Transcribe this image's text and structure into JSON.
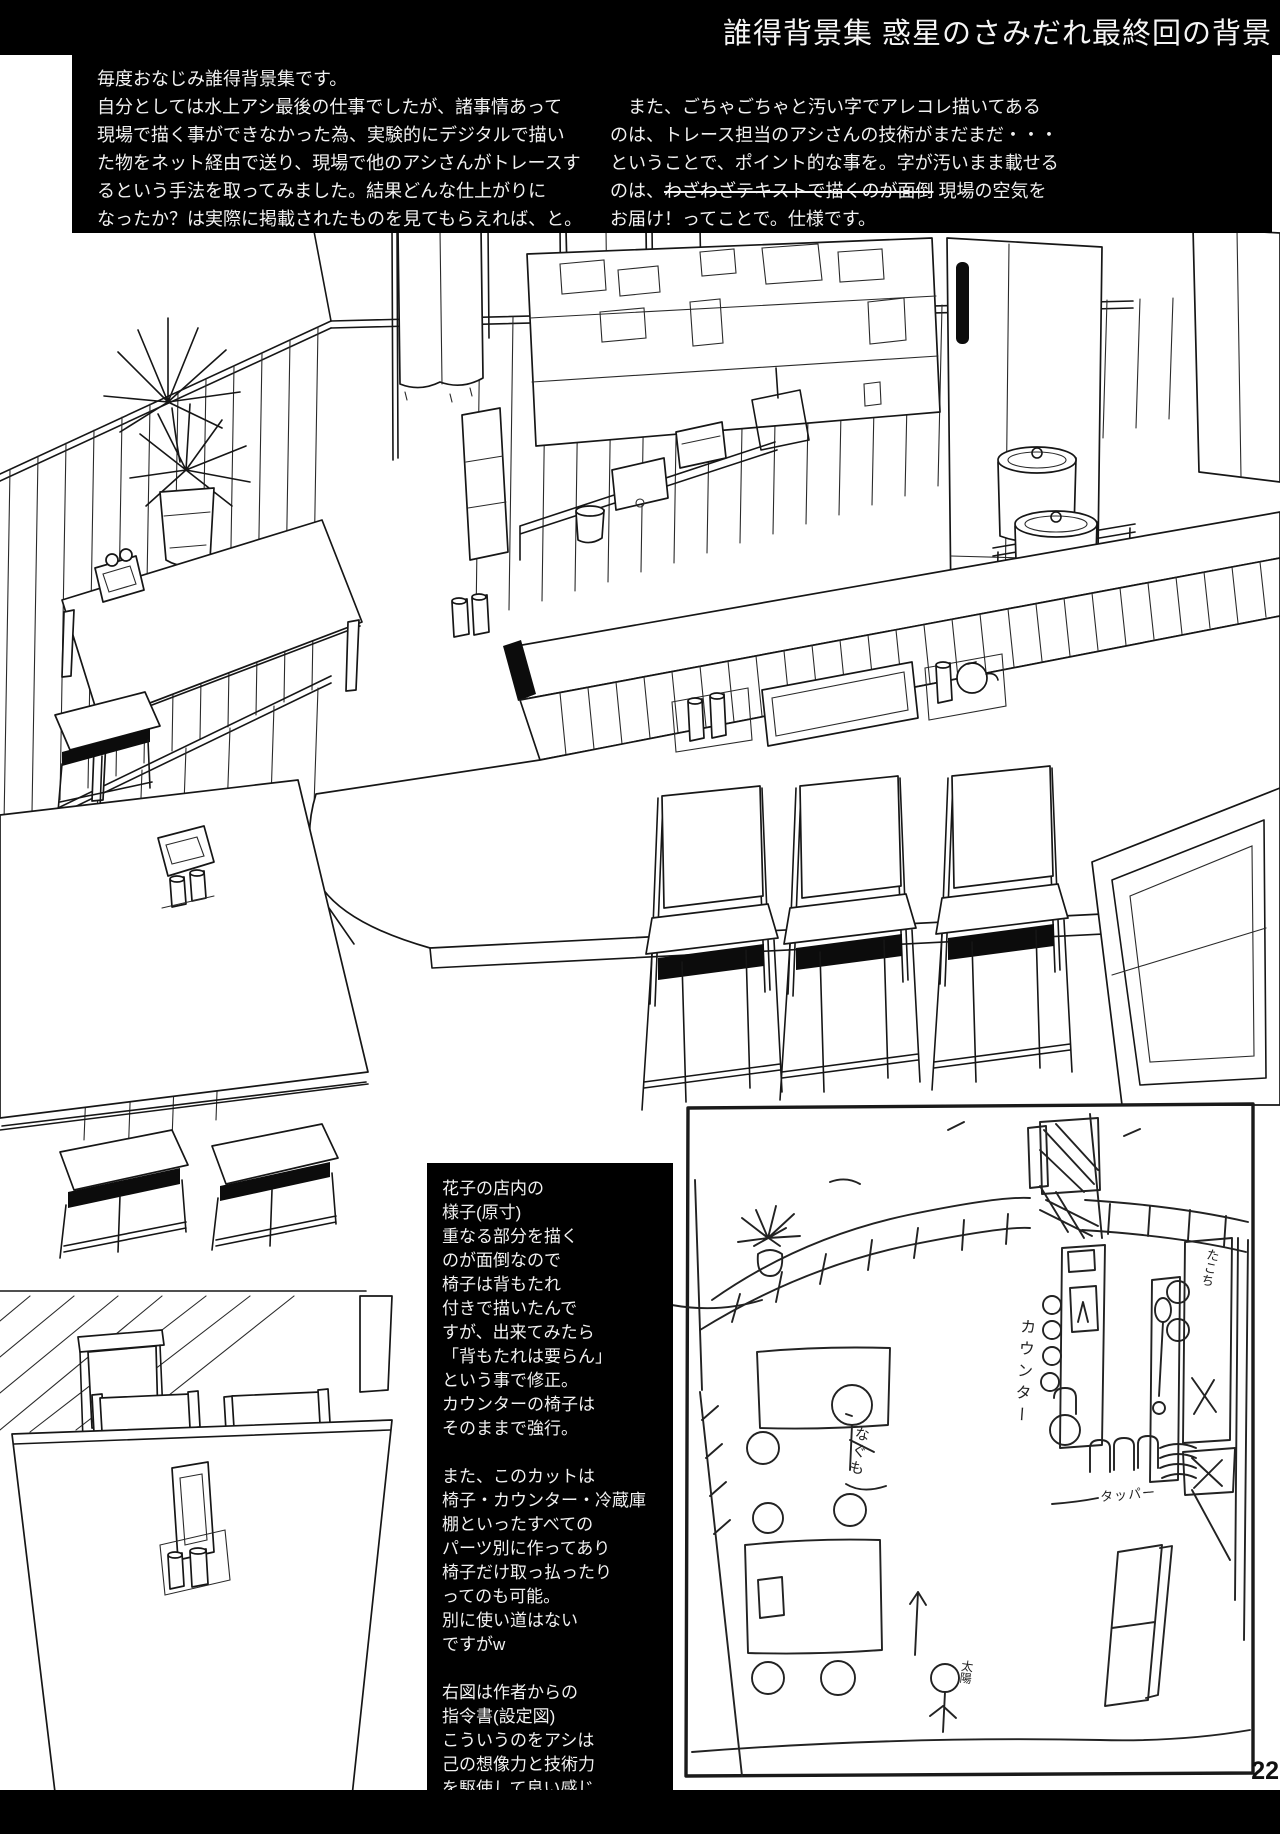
{
  "header": {
    "title": "誰得背景集 惑星のさみだれ最終回の背景"
  },
  "intro": {
    "left": "毎度おなじみ誰得背景集です。\n自分としては水上アシ最後の仕事でしたが、諸事情あって\n現場で描く事ができなかった為、実験的にデジタルで描い\nた物をネット経由で送り、現場で他のアシさんがトレースす\nるという手法を取ってみました。結果どんな仕上がりに\nなったか？は実際に掲載されたものを見てもらえれば、と。",
    "right_pre": "　また、ごちゃごちゃと汚い字でアレコレ描いてある\nのは、トレース担当のアシさんの技術がまだまだ・・・\nということで、ポイント的な事を。字が汚いまま載せる\nのは、",
    "right_struck": "わざわざテキストで描くのが面倒",
    "right_post": " 現場の空気を\nお届け！ってことで。仕様です。"
  },
  "note": {
    "text": "花子の店内の\n様子(原寸)\n重なる部分を描く\nのが面倒なので\n椅子は背もたれ\n付きで描いたんで\nすが、出来てみたら\n「背もたれは要らん」\nという事で修正。\nカウンターの椅子は\nそのままで強行。\n\nまた、このカットは\n椅子・カウンター・冷蔵庫\n棚といったすべての\nパーツ別に作ってあり\n椅子だけ取っ払ったり\nってのも可能。\n別に使い道はない\nですがw\n\n右図は作者からの\n指令書(設定図)\nこういうのをアシは\n己の想像力と技術力\nを駆使して良い感じ\nに描く。そういう仕事\nなのです。多分。"
  },
  "sketch": {
    "labels": {
      "customer_name": "なぐも",
      "counter": "カウンター",
      "container": "タッパー",
      "shelf": "たこち",
      "sun": "太陽"
    }
  },
  "page_number": "22",
  "colors": {
    "ink": "#161616",
    "paper": "#ffffff",
    "panel": "#000000"
  }
}
